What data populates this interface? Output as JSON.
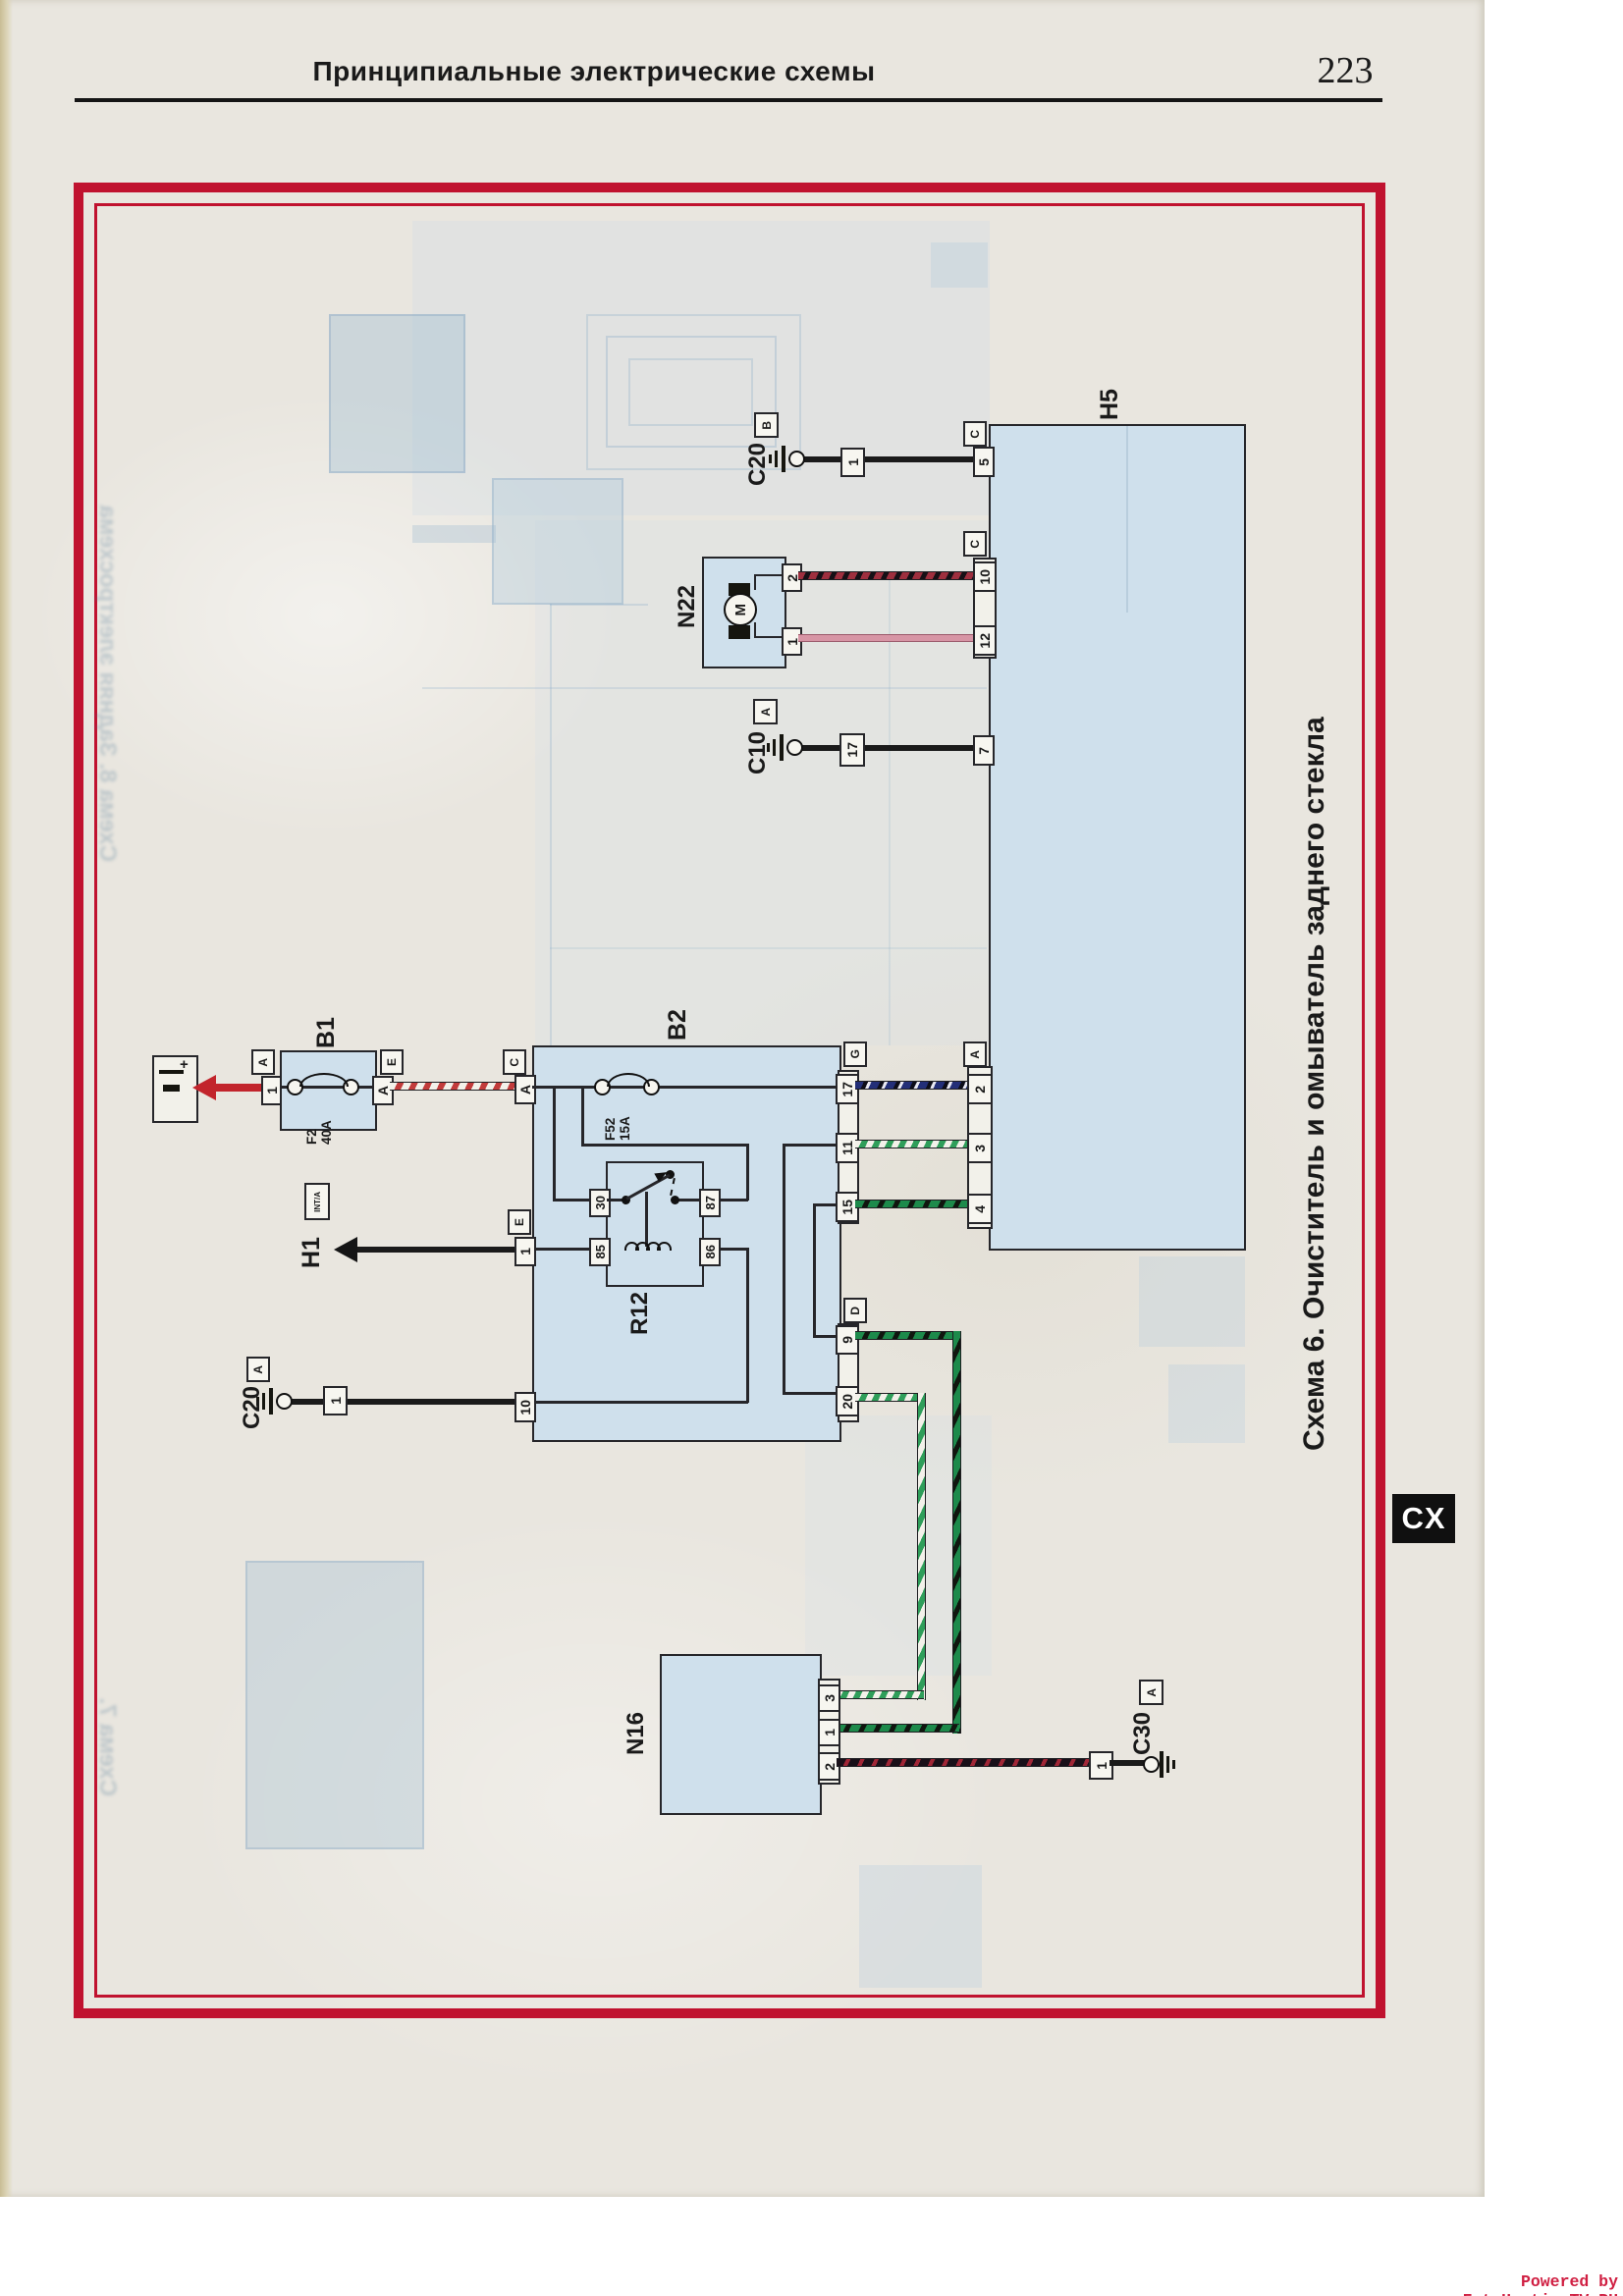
{
  "page": {
    "header_title": "Принципиальные электрические схемы",
    "page_number": "223",
    "caption": "Схема 6. Очиститель и омыватель заднего стекла",
    "side_tab": "CX",
    "watermark": "Powered by FotoHostingTV.RU"
  },
  "colors": {
    "frame_red": "#c0122f",
    "component_fill": "#cfe0ec",
    "wire_black": "#1a1a1a",
    "wire_red": "#c2242c",
    "wire_pink": "#d795a5",
    "stripe_red_white": "#c23b3b",
    "stripe_green_white": "#2f9e5a",
    "stripe_green_black": "#1d8a4b",
    "stripe_navy_black": "#222f77",
    "stripe_red_black": "#9e2f3e"
  },
  "b1": {
    "label": "B1",
    "fuse_name": "F2",
    "fuse_rating": "40A",
    "pin_1": "1",
    "tag_1": "A",
    "pin_a": "A",
    "tag_a": "E"
  },
  "b2": {
    "label": "B2",
    "fuse_name": "F52",
    "fuse_rating": "15A",
    "pin_a": "A",
    "tag_a": "C",
    "pin_1": "1",
    "tag_1": "E",
    "pin_10": "10",
    "pin_17": "17",
    "tag_17": "G",
    "pin_11": "11",
    "pin_15": "15",
    "pin_9": "9",
    "tag_9": "D",
    "pin_20": "20"
  },
  "r12": {
    "label": "R12",
    "pin_30": "30",
    "pin_87": "87",
    "pin_85": "85",
    "pin_86": "86"
  },
  "h5": {
    "label": "H5",
    "pin_5": "5",
    "tag_5": "C",
    "pin_10": "10",
    "tag_10": "C",
    "pin_12": "12",
    "pin_7": "7",
    "pin_2": "2",
    "tag_2": "A",
    "pin_3": "3",
    "pin_4": "4"
  },
  "n22": {
    "label": "N22",
    "motor_letter": "M",
    "pin_2": "2",
    "pin_1": "1"
  },
  "n16": {
    "label": "N16",
    "pin_3": "3",
    "pin_1": "1",
    "pin_2": "2"
  },
  "h1": {
    "label": "H1",
    "tag": "INT/A"
  },
  "c20_top": {
    "label": "C20",
    "tag": "B",
    "connector": "1"
  },
  "c10": {
    "label": "C10",
    "tag": "A",
    "connector": "17"
  },
  "c20_left": {
    "label": "C20",
    "tag": "A",
    "connector": "1"
  },
  "c30": {
    "label": "C30",
    "tag": "A",
    "connector": "1"
  },
  "ghost": {
    "left_top": "Схема 8. Задняя электросхема",
    "left_bottom": "Схема 7."
  }
}
